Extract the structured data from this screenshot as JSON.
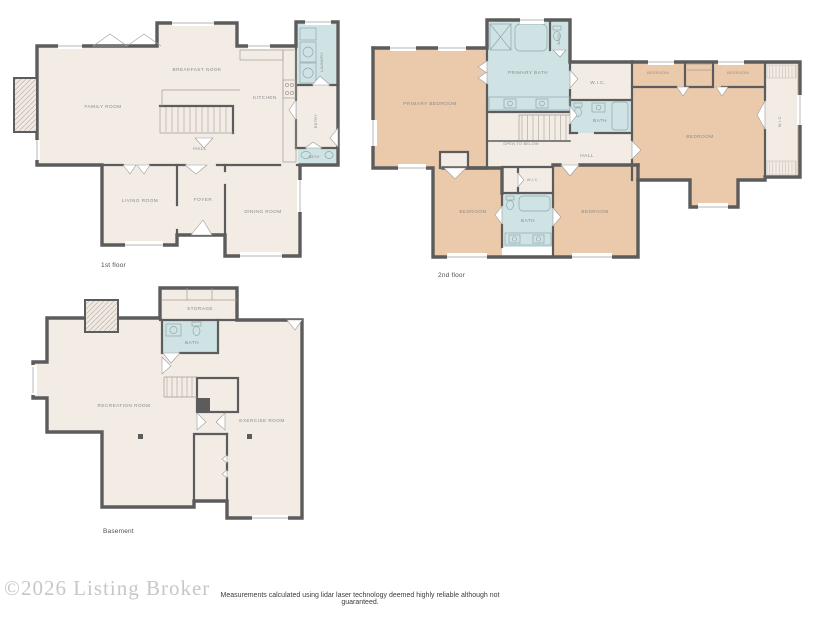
{
  "colors": {
    "floor": "#f2ece5",
    "bedroom": "#ebcaab",
    "bath": "#cfe3e4",
    "wall": "#5c5c5c",
    "label": "#8a8a8a"
  },
  "floors": {
    "first": {
      "caption": "1st floor",
      "rooms": {
        "family_room": "FAMILY ROOM",
        "breakfast_nook": "BREAKFAST NOOK",
        "kitchen": "KITCHEN",
        "laundry": "LAUNDRY",
        "entry": "ENTRY",
        "hall": "HALL",
        "bath": "BATH",
        "living_room": "LIVING ROOM",
        "foyer": "FOYER",
        "dining_room": "DINING ROOM"
      }
    },
    "second": {
      "caption": "2nd floor",
      "rooms": {
        "primary_bedroom": "PRIMARY BEDROOM",
        "primary_bath": "PRIMARY BATH",
        "water_closet": "BATH",
        "wic_hall": "W.I.C.",
        "bath_hall": "BATH",
        "hall": "HALL",
        "open_to_below": "OPEN TO BELOW",
        "bedroom_top_left": "BEDROOM",
        "bedroom_top_right": "BEDROOM",
        "bedroom_large": "BEDROOM",
        "wic_right": "W.I.C.",
        "bedroom_bottom_left": "BEDROOM",
        "wic_small": "W.I.C.",
        "bath_bottom": "BATH",
        "bedroom_bottom_right": "BEDROOM"
      }
    },
    "basement": {
      "caption": "Basement",
      "rooms": {
        "storage": "STORAGE",
        "bath": "BATH",
        "recreation_room": "RECREATION ROOM",
        "exercise_room": "EXERCISE ROOM"
      }
    }
  },
  "footer": {
    "watermark": "©2026 Listing Broker",
    "disclaimer": "Measurements calculated using lidar laser technology deemed highly reliable although not guaranteed."
  }
}
